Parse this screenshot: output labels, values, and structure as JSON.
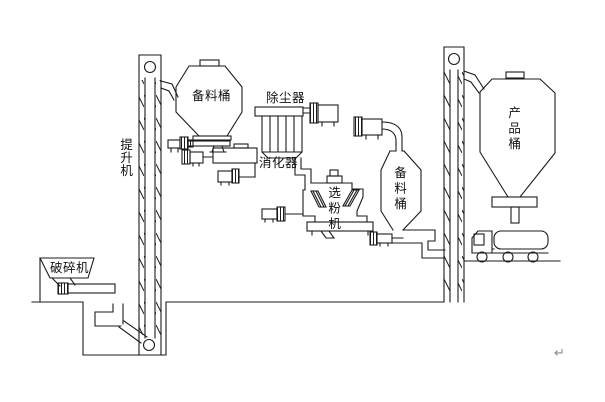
{
  "diagram": {
    "type": "process-flow-diagram",
    "background": "#ffffff",
    "line_color": "#1b1b1b",
    "labels": {
      "crusher": "破碎机",
      "elevator_left": "提升机",
      "stock_bin_left": "备料桶",
      "dust_collector": "除尘器",
      "digester": "消化器",
      "separator": "选粉机",
      "stock_bin_middle": "备料桶",
      "product_bin": "产品桶"
    },
    "return_mark": "↵"
  }
}
